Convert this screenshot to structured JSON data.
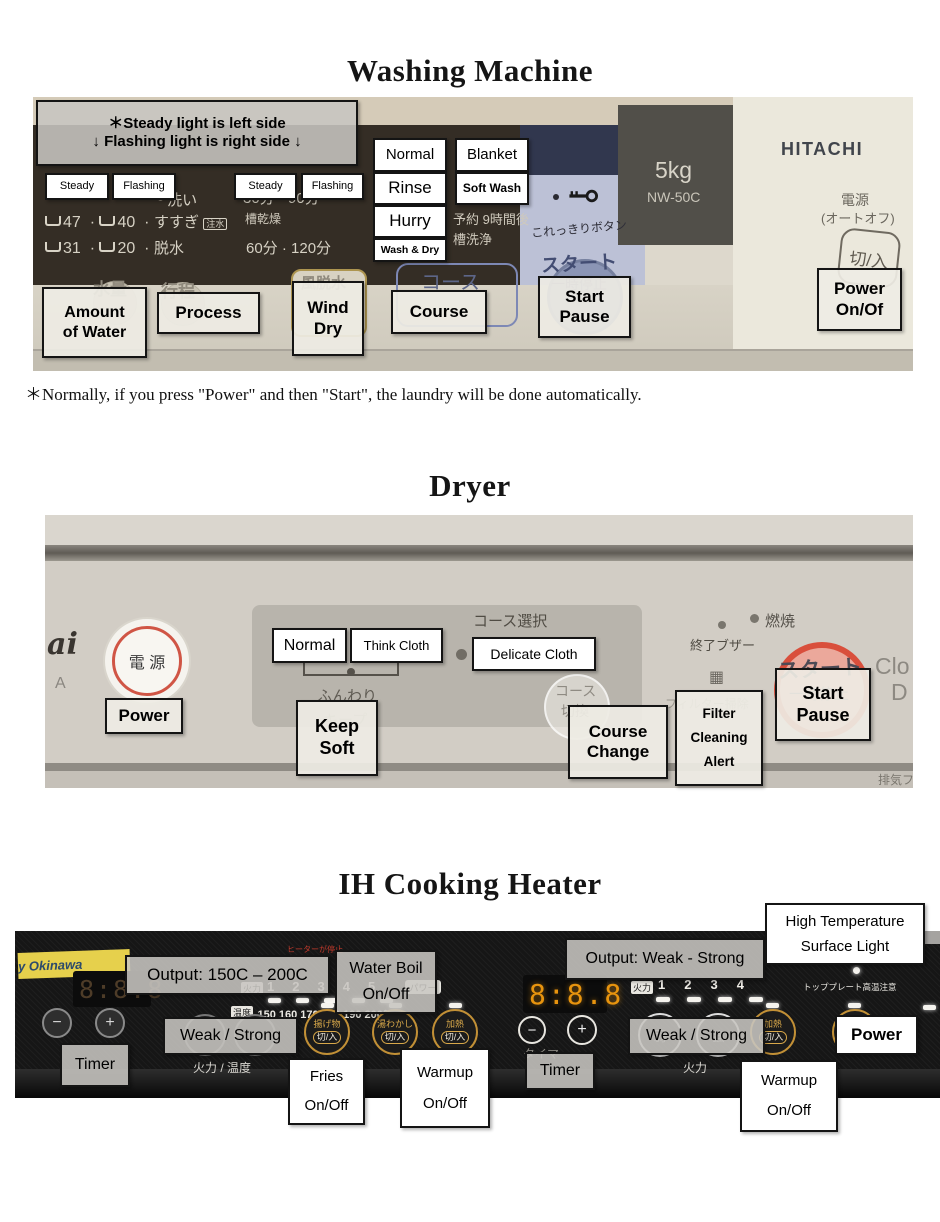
{
  "colors": {
    "label_border": "#141414",
    "start_button_red": "#d94f3c",
    "power_ring_red": "#d05545",
    "gold_ring": "#c29036",
    "led_white": "#f5f3ee",
    "display_orange": "#e8940e",
    "blue_strip": "#bcc1d6"
  },
  "titles": {
    "washer": "Washing Machine",
    "dryer": "Dryer",
    "ih": "IH Cooking Heater"
  },
  "washer": {
    "note": {
      "line1": "＊Steady light is left side",
      "line2": "↓ Flashing light is right side ↓"
    },
    "footnote": "＊Normally, if you press \"Power\" and then \"Start\", the laundry will be done automatically.",
    "annotations": {
      "steady1": "Steady",
      "flashing1": "Flashing",
      "steady2": "Steady",
      "flashing2": "Flashing",
      "normal": "Normal",
      "blanket": "Blanket",
      "rinse": "Rinse",
      "soft_wash": "Soft Wash",
      "hurry": "Hurry",
      "wash_dry": "Wash & Dry",
      "amount1": "Amount",
      "amount2": "of Water",
      "process": "Process",
      "wind1": "Wind",
      "wind2": "Dry",
      "course": "Course",
      "start": "Start",
      "pause": "Pause",
      "power1": "Power",
      "power2": "On/Of"
    },
    "panel": {
      "w47": "47",
      "w40": "40",
      "w31": "31",
      "w20": "20",
      "wash": "洗い",
      "rinse": "すすぎ",
      "rinse_tag": "注水",
      "spin": "脱水",
      "min30": "30分",
      "min90": "90分",
      "tub_dry": "槽乾燥",
      "min60": "60分",
      "min120": "120分",
      "reserve": "予約 9時間後",
      "tub_wash": "槽洗浄",
      "koredake": "これっきりボタン",
      "start_jp": "スタート",
      "pause_jp": "一時停止",
      "capacity": "5kg",
      "model": "NW-50C",
      "brand": "HITACHI",
      "power_jp": "電源",
      "auto_off": "(オートオフ)",
      "on_off": "切/入",
      "water": "水量",
      "process_jp": "行程",
      "wind_jp": "風脱水",
      "course_jp": "コース"
    }
  },
  "dryer": {
    "annotations": {
      "normal": "Normal",
      "think": "Think Cloth",
      "delicate": "Delicate Cloth",
      "power": "Power",
      "keep1": "Keep",
      "keep2": "Soft",
      "course1": "Course",
      "course2": "Change",
      "filter1": "Filter",
      "filter2": "Cleaning",
      "filter3": "Alert",
      "start": "Start",
      "pause": "Pause"
    },
    "panel": {
      "brand": "ai",
      "brand2": "A",
      "power_jp": "電 源",
      "course_select": "コース選択",
      "funwari": "ふんわり",
      "keep_ghost": "キープ",
      "kirikae1": "コース",
      "kirikae2": "切換",
      "buzzer": "終了ブザー",
      "filter_ghost": "フィルター掃除",
      "filter_icon": "▦",
      "burn": "燃焼",
      "start_jp": "スタート",
      "pause_jp": "一時停止",
      "logo1": "Clo",
      "logo2": "D",
      "exhaust": "排気フィル"
    }
  },
  "ih": {
    "annotations": {
      "output_left": "Output: 150C – 200C",
      "water1": "Water Boil",
      "water2": "On/Off",
      "weak_left": "Weak / Strong",
      "timer_left": "Timer",
      "fries1": "Fries",
      "fries2": "On/Off",
      "warm_a1": "Warmup",
      "warm_a2": "On/Off",
      "output_right": "Output: Weak - Strong",
      "high1": "High Temperature",
      "high2": "Surface Light",
      "timer_right": "Timer",
      "weak_right": "Weak / Strong",
      "warm_b1": "Warmup",
      "warm_b2": "On/Off",
      "power": "Power"
    },
    "panel": {
      "sticker": "y Okinawa",
      "display_left": "8:8.8",
      "display_right": "8:8.8",
      "karyoku": "火力",
      "ondo": "温度",
      "levels_left": [
        "1",
        "2",
        "3",
        "4",
        "5"
      ],
      "power_tag": "パワー",
      "temps": "150 160 170 180 190 200℃",
      "karyoku_ondo": "火力 / 温度",
      "karyoku2": "火力",
      "minus": "−",
      "plus": "+",
      "lt": "<",
      "gt": ">",
      "weak": "弱",
      "strong": "強",
      "agemono": "揚げ物",
      "yuwakashi": "湯わかし",
      "kanetsu": "加熱",
      "dengen": "電源",
      "onoff": "切/入",
      "timer_ghost": "タイマー",
      "levels_right": [
        "1",
        "2",
        "3",
        "4"
      ],
      "top_plate": "トッププレート高温注意",
      "warning": "ヒーターが停止"
    }
  }
}
